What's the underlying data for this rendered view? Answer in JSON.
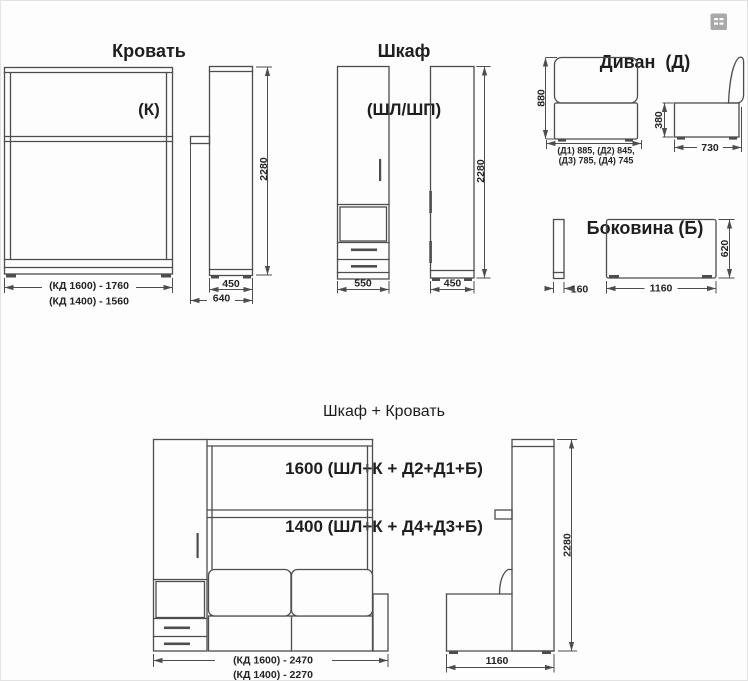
{
  "meta": {
    "background": "#fdfdfd",
    "line_color": "#4d4d4d",
    "text_color": "#242424",
    "icon_color": "#a9a9a9"
  },
  "bed": {
    "title": "Кровать",
    "code": "(К)",
    "dim_width_1600": "(КД 1600) - 1760",
    "dim_width_1400": "(КД 1400) - 1560",
    "dim_side_width": "450",
    "dim_side_depth": "640",
    "dim_height": "2280"
  },
  "cabinet": {
    "title": "Шкаф",
    "code": "(ШЛ/ШП)",
    "dim_width": "550",
    "dim_side_depth": "450",
    "dim_height": "2280"
  },
  "sofa": {
    "title": "Диван  (Д)",
    "dim_height": "880",
    "dim_widths_line1": "(Д1) 885, (Д2) 845,",
    "dim_widths_line2": "(Д3) 785, (Д4) 745",
    "dim_seat_height": "380",
    "dim_side_depth": "730"
  },
  "sidewall": {
    "title": "Боковина (Б)",
    "dim_thickness": "160",
    "dim_length": "1160",
    "dim_height": "620"
  },
  "combo": {
    "title": "Шкаф + Кровать",
    "variant_1600": "1600 (ШЛ+К + Д2+Д1+Б)",
    "variant_1400": "1400 (ШЛ+К + Д4+Д3+Б)",
    "dim_width_1600": "(КД 1600) - 2470",
    "dim_width_1400": "(КД 1400) - 2270",
    "dim_side_depth": "1160",
    "dim_height": "2280"
  },
  "ui": {
    "thumbnail_icon": "image-placeholder"
  }
}
